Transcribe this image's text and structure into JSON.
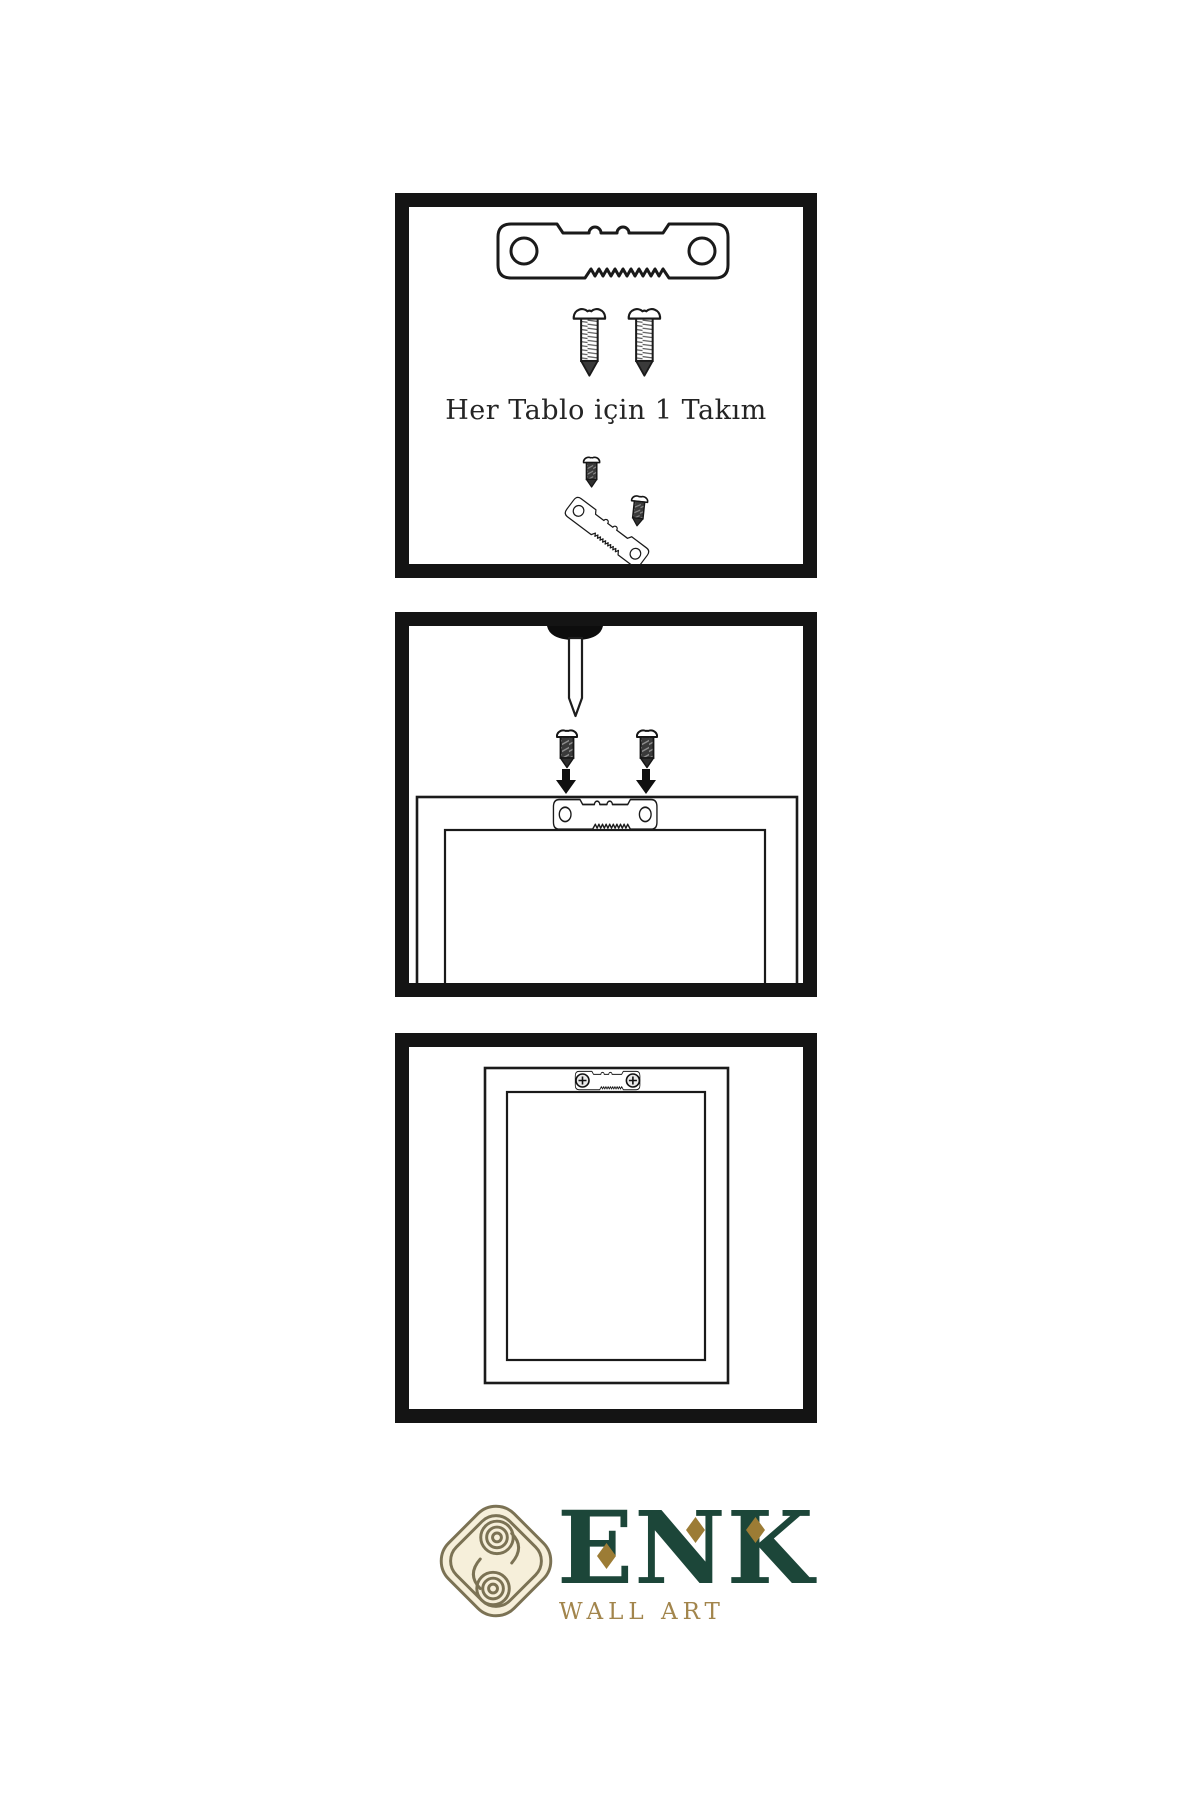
{
  "page": {
    "background_color": "#ffffff",
    "ink_color": "#141414"
  },
  "instructions": {
    "step1": {
      "caption": "Her Tablo için 1 Takım",
      "icons": [
        "sawtooth-hanger",
        "screw",
        "screw",
        "screw-and-hanger-angled"
      ]
    },
    "step2": {
      "icons": [
        "wall-nail",
        "screw",
        "screw",
        "down-arrow",
        "down-arrow",
        "frame-back-with-sawtooth-hanger"
      ]
    },
    "step3": {
      "icons": [
        "hanging-frame-with-mounted-hanger"
      ]
    }
  },
  "brand": {
    "name": "ENK",
    "tagline": "WALL ART",
    "name_color": "#1c4639",
    "accent_gold": "#9c7c35",
    "tagline_color": "#a2854c",
    "knot_stroke_color": "#7b7254",
    "knot_fill_color": "#f6efda"
  }
}
